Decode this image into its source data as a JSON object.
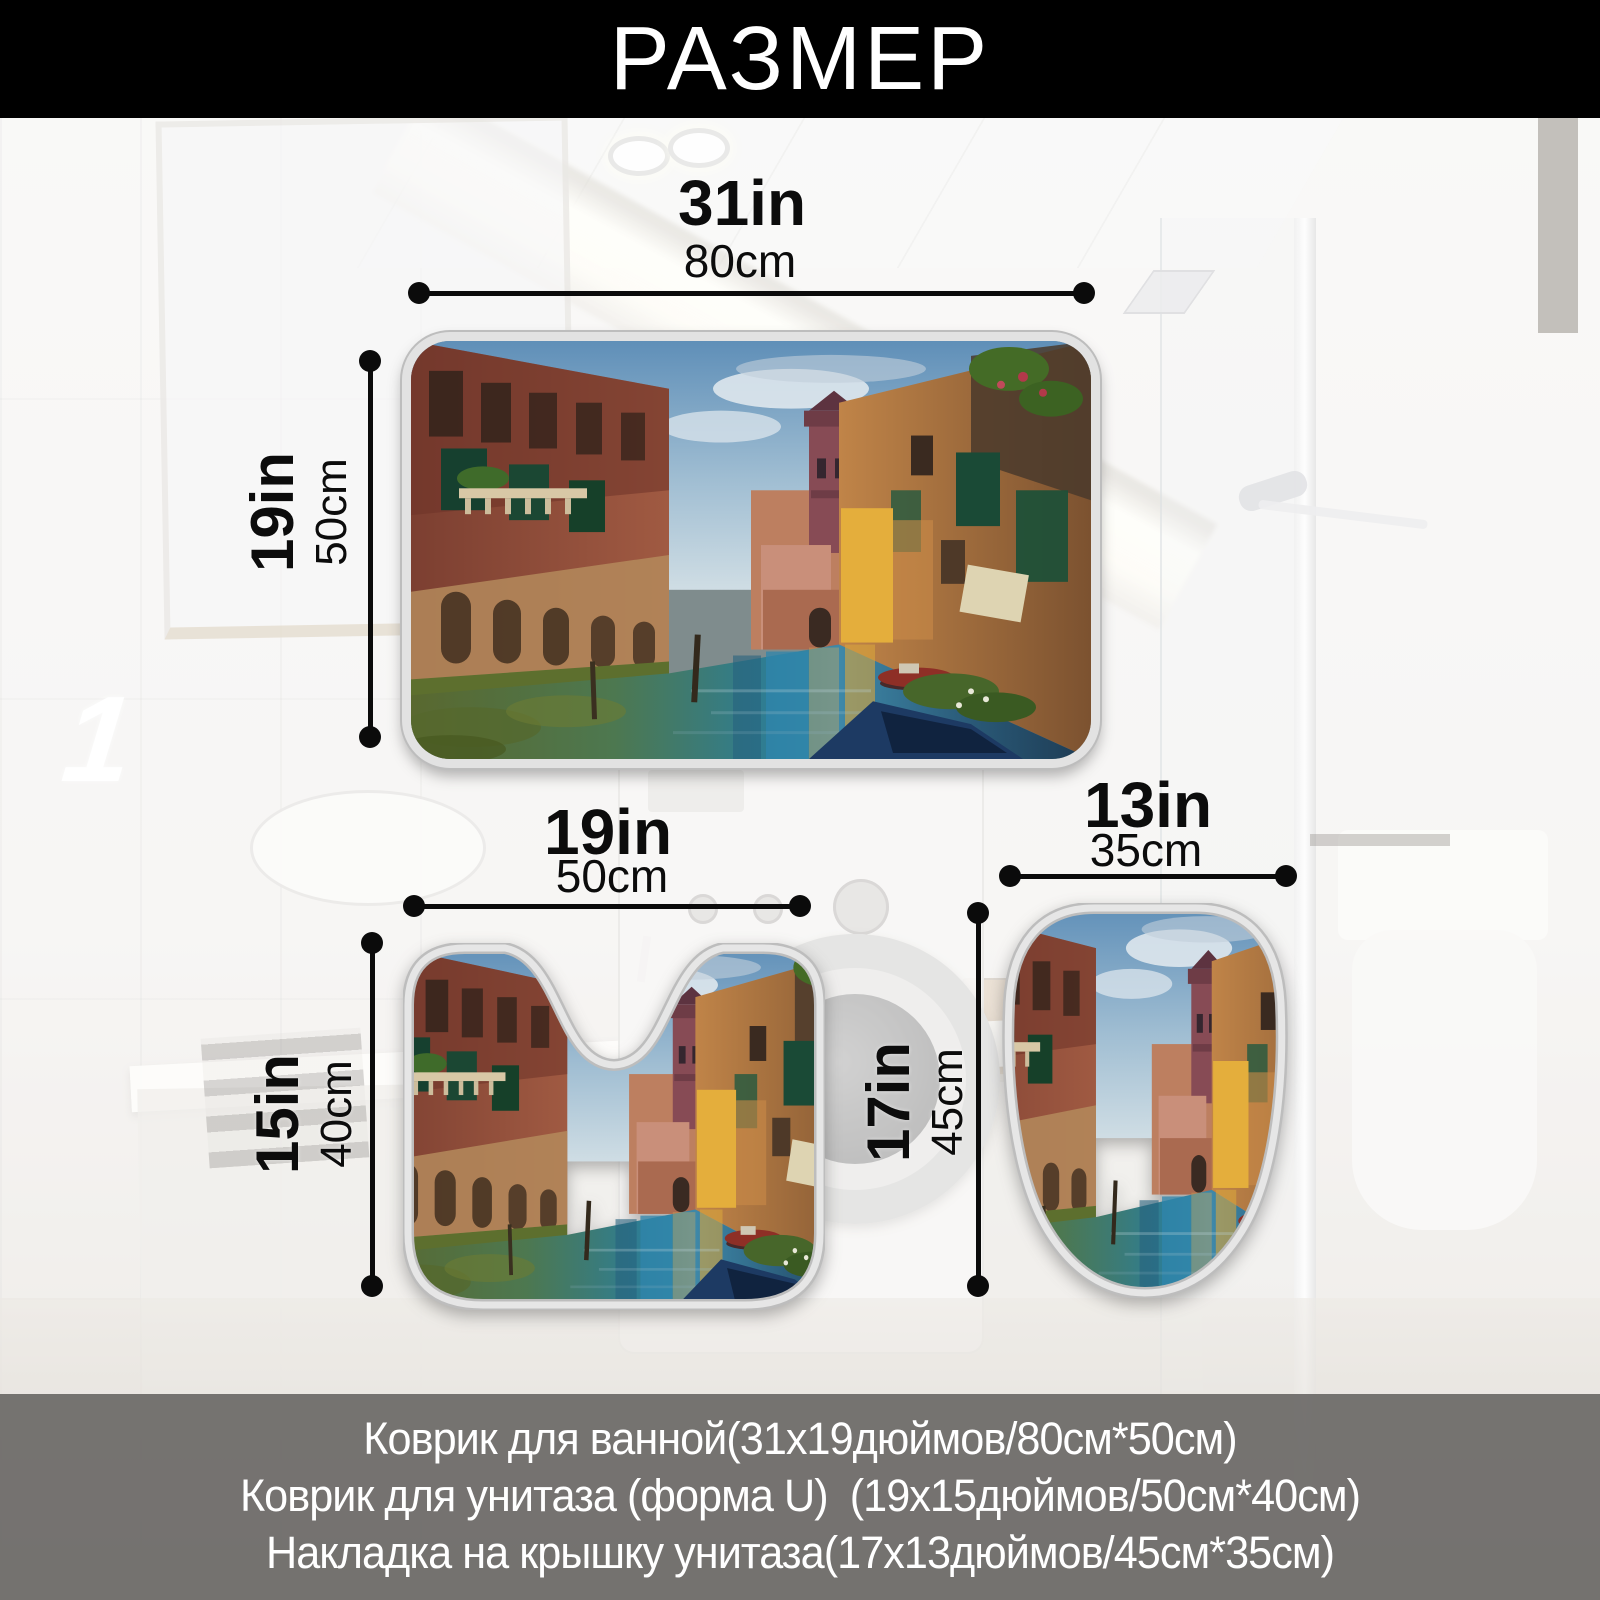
{
  "title": "РАЗМЕР",
  "index_label": "1",
  "artwork": "Venice canal oil painting",
  "bath_mat": {
    "width_in": "31in",
    "width_cm": "80cm",
    "height_in": "19in",
    "height_cm": "50cm"
  },
  "contour_mat": {
    "width_in": "19in",
    "width_cm": "50cm",
    "height_in": "15in",
    "height_cm": "40cm"
  },
  "lid_cover": {
    "width_in": "13in",
    "width_cm": "35cm",
    "height_in": "17in",
    "height_cm": "45cm"
  },
  "footer_lines": [
    "Коврик для ванной(31x19дюймов/80см*50см)",
    "Коврик для унитаза (форма U)  (19x15дюймов/50см*40см)",
    "Накладка на крышку унитаза(17x13дюймов/45см*35см)"
  ],
  "colors": {
    "banner": "#000000",
    "dimension_lines": "#0b0b0b",
    "footer_band": "#686664",
    "footer_text": "#ffffff",
    "mat_border": "#e2e2e2"
  }
}
